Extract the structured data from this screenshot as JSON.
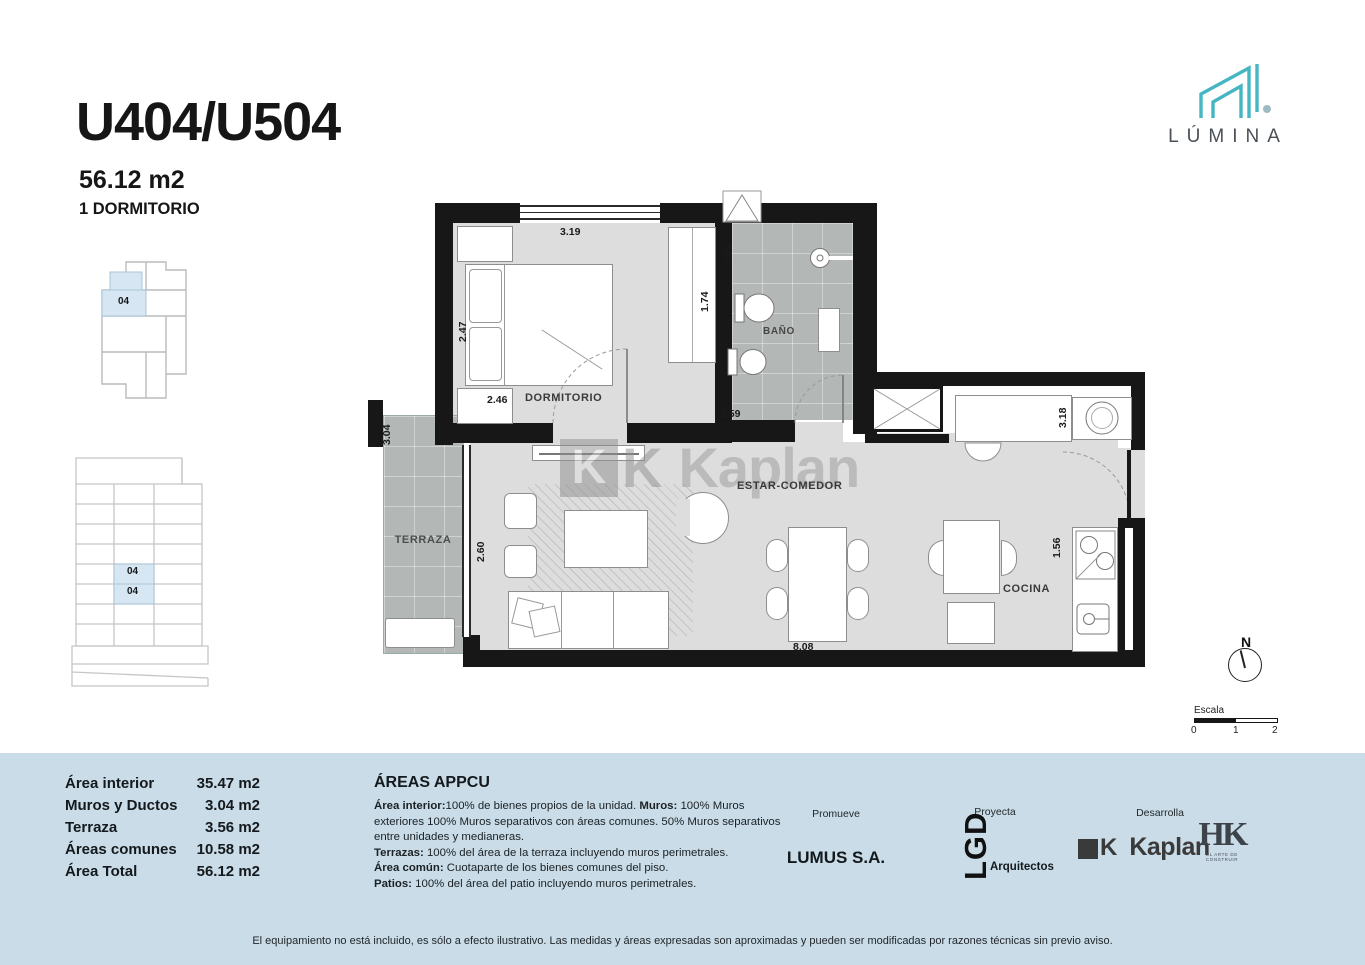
{
  "colors": {
    "accent_teal": "#45b6c2",
    "panel_blue": "#c9dce7",
    "wall_black": "#171717",
    "floor_gray": "#dcdddc",
    "wet_floor_gray": "#b3b7b5"
  },
  "header": {
    "unit": "U404/U504",
    "area": "56.12 m2",
    "type": "1 DORMITORIO"
  },
  "brand": {
    "wordmark": "LÚMINA"
  },
  "keyplans": {
    "unit_label": "04"
  },
  "plan": {
    "rooms": {
      "dormitorio": "DORMITORIO",
      "bano": "BAÑO",
      "estar_comedor": "ESTAR-COMEDOR",
      "terraza": "TERRAZA",
      "cocina": "COCINA"
    },
    "dims": {
      "bedroom_width": "3.19",
      "bedroom_height": "2.47",
      "closet": "1.74",
      "bedroom_bottom": "2.46",
      "bath_height": "2.53",
      "bath_width": "1.59",
      "terrace_height": "3.04",
      "living_window": "2.60",
      "laundry": "3.18",
      "kitchen": "1.56",
      "living_width": "8.08"
    },
    "watermark_k": "K",
    "watermark": "Kaplan"
  },
  "compass": {
    "north": "N"
  },
  "scalebar": {
    "label": "Escala",
    "ticks": [
      "0",
      "1",
      "2"
    ]
  },
  "areas": {
    "rows": [
      {
        "label": "Área interior",
        "value": "35.47 m2"
      },
      {
        "label": "Muros y Ductos",
        "value": "3.04 m2"
      },
      {
        "label": "Terraza",
        "value": "3.56 m2"
      },
      {
        "label": "Áreas comunes",
        "value": "10.58 m2"
      },
      {
        "label": "Área Total",
        "value": "56.12 m2"
      }
    ]
  },
  "appcu": {
    "title": "ÁREAS APPCU",
    "l1b1": "Área interior:",
    "l1t1": "100% de bienes propios de la unidad.  ",
    "l1b2": "Muros:",
    "l1t2": " 100% Muros exteriores 100% Muros separativos con áreas comunes.  50%  Muros separativos entre unidades y medianeras.",
    "l4b": "Terrazas:",
    "l4t": " 100% del área de la terraza incluyendo muros perimetrales.",
    "l5b": "Área común:",
    "l5t": " Cuotaparte de los bienes comunes del piso.",
    "l6b": "Patios:",
    "l6t": " 100% del área del patio incluyendo muros perimetrales."
  },
  "credits": {
    "promueve_label": "Promueve",
    "promueve": "LUMUS S.A.",
    "proyecta_label": "Proyecta",
    "proyecta_logo": "LGD",
    "proyecta_sub": "Arquitectos",
    "desarrolla_label": "Desarrolla",
    "kaplan_k": "K",
    "kaplan": "Kaplan",
    "hk": "HK",
    "hk_sub": "EL ARTE DE CONSTRUIR"
  },
  "disclaimer": "El equipamiento no está incluido, es sólo a efecto ilustrativo. Las medidas y áreas expresadas son aproximadas y pueden ser modificadas por razones técnicas sin previo aviso."
}
